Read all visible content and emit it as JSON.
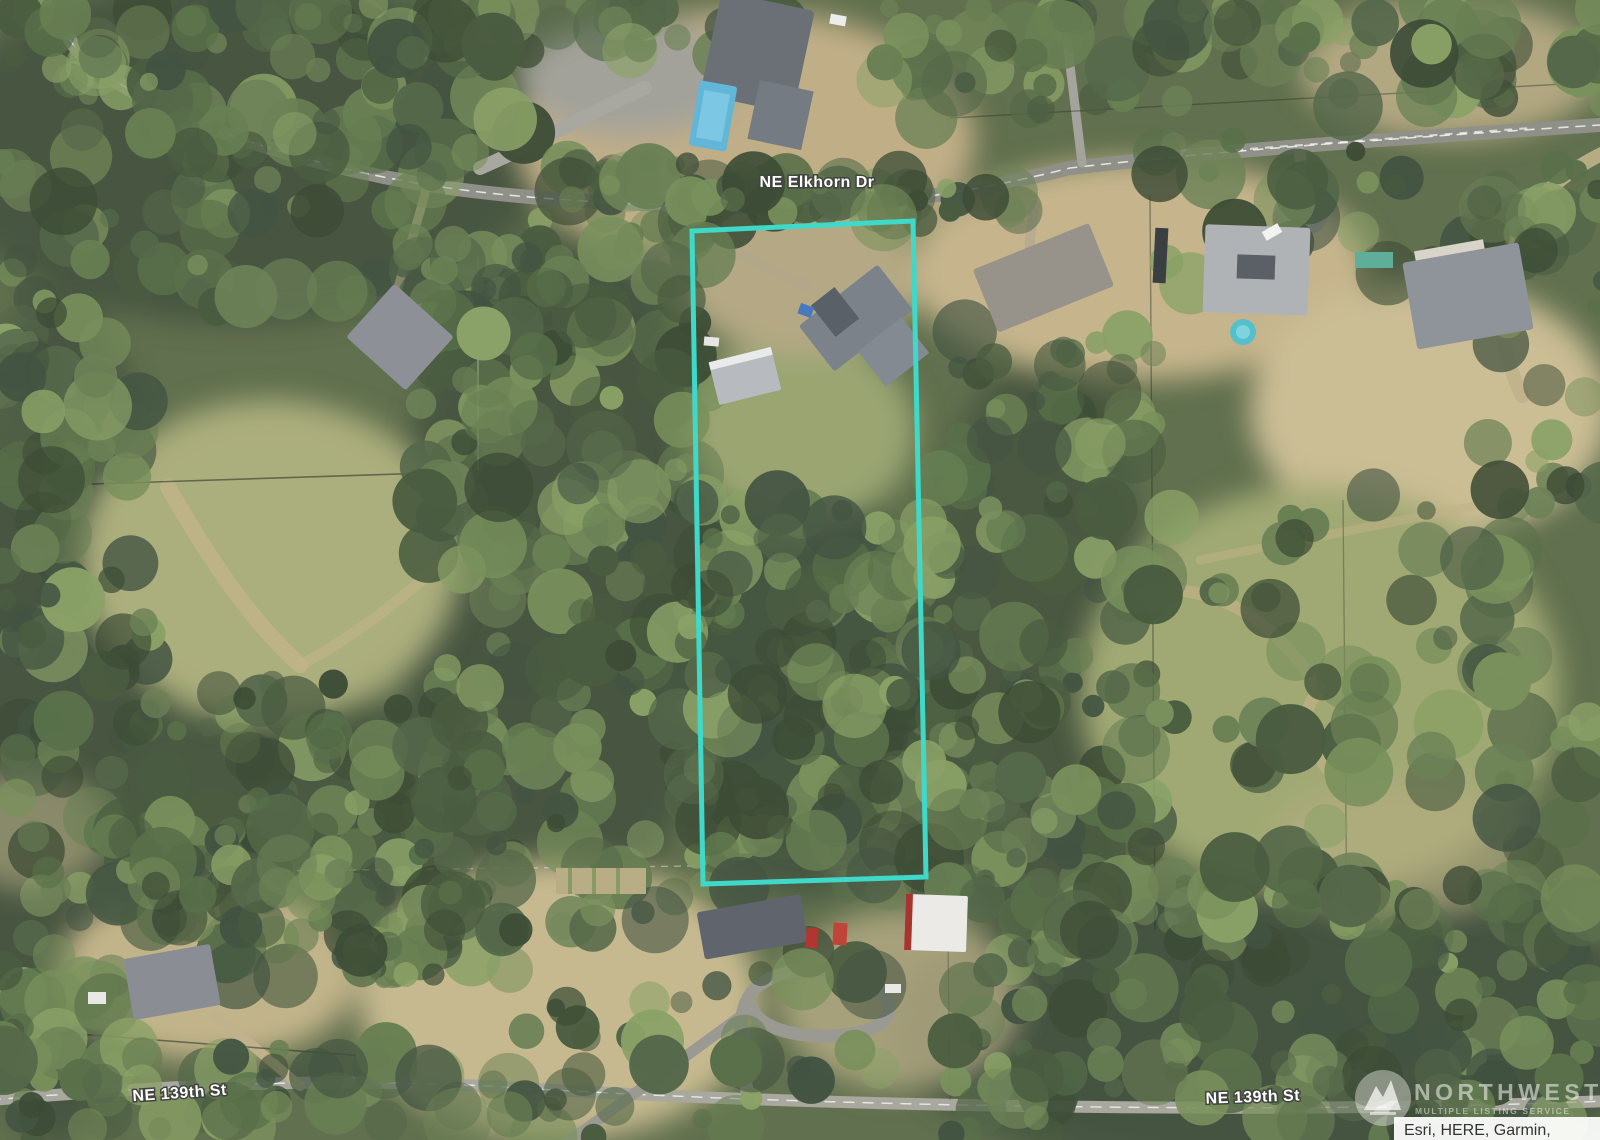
{
  "map": {
    "labels": {
      "road_top": "NE Elkhorn Dr",
      "road_bottom_left": "NE 139th St",
      "road_bottom_right": "NE 139th St"
    },
    "watermark": {
      "title": "NORTHWEST",
      "subtitle": "MULTIPLE LISTING SERVICE"
    },
    "attribution": "Esri, HERE, Garmin,",
    "colors": {
      "boundary": "#3fd9ca",
      "label_fill": "#ffffff",
      "label_halo": "#41443f",
      "attribution_text": "#333333",
      "attribution_bg": "#ffffff",
      "watermark_tint": "#f4f4ef"
    },
    "parcel": {
      "points": [
        [
          692,
          231
        ],
        [
          913,
          221
        ],
        [
          926,
          877
        ],
        [
          703,
          884
        ]
      ],
      "stroke_width": 5
    }
  }
}
